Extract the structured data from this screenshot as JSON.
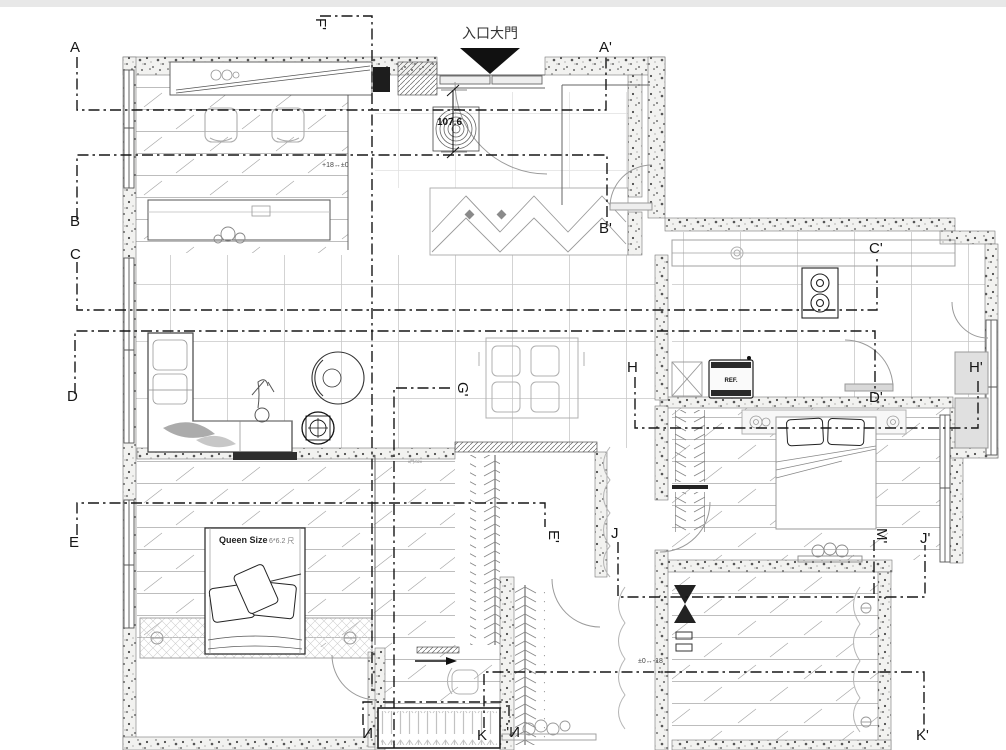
{
  "drawing": {
    "entrance_label": "入口大門",
    "entry_dimension": "107.6",
    "level_note_left": "+18↔±0",
    "level_note_right": "±0↔-18",
    "queen_bed_label": "Queen Size",
    "queen_bed_size": "6*6.2 尺",
    "fridge_label": "REF.",
    "closet_note": "#門/02#"
  },
  "section_markers": [
    {
      "id": "A",
      "text": "A"
    },
    {
      "id": "A-prime",
      "text": "A'"
    },
    {
      "id": "B",
      "text": "B"
    },
    {
      "id": "B-prime",
      "text": "B'"
    },
    {
      "id": "C",
      "text": "C"
    },
    {
      "id": "C-prime",
      "text": "C'"
    },
    {
      "id": "D",
      "text": "D"
    },
    {
      "id": "D-prime",
      "text": "D'"
    },
    {
      "id": "E",
      "text": "E"
    },
    {
      "id": "E-prime",
      "text": "E'"
    },
    {
      "id": "F-prime",
      "text": "F'"
    },
    {
      "id": "G-prime",
      "text": "G'"
    },
    {
      "id": "H",
      "text": "H"
    },
    {
      "id": "H-prime",
      "text": "H'"
    },
    {
      "id": "J",
      "text": "J"
    },
    {
      "id": "J-prime",
      "text": "J'"
    },
    {
      "id": "M-prime",
      "text": "M'"
    },
    {
      "id": "K",
      "text": "K"
    },
    {
      "id": "K-prime",
      "text": "K'"
    },
    {
      "id": "N",
      "text": "N"
    },
    {
      "id": "N-prime",
      "text": "N'"
    }
  ],
  "colors": {
    "ink": "#1a1a1a",
    "furniture_gray": "#9c9c9c",
    "floor_line": "#b9b9b9",
    "wall_speckle_bg": "#f2f2f0",
    "paper": "#ffffff",
    "top_bar": "#e8e8e8"
  }
}
